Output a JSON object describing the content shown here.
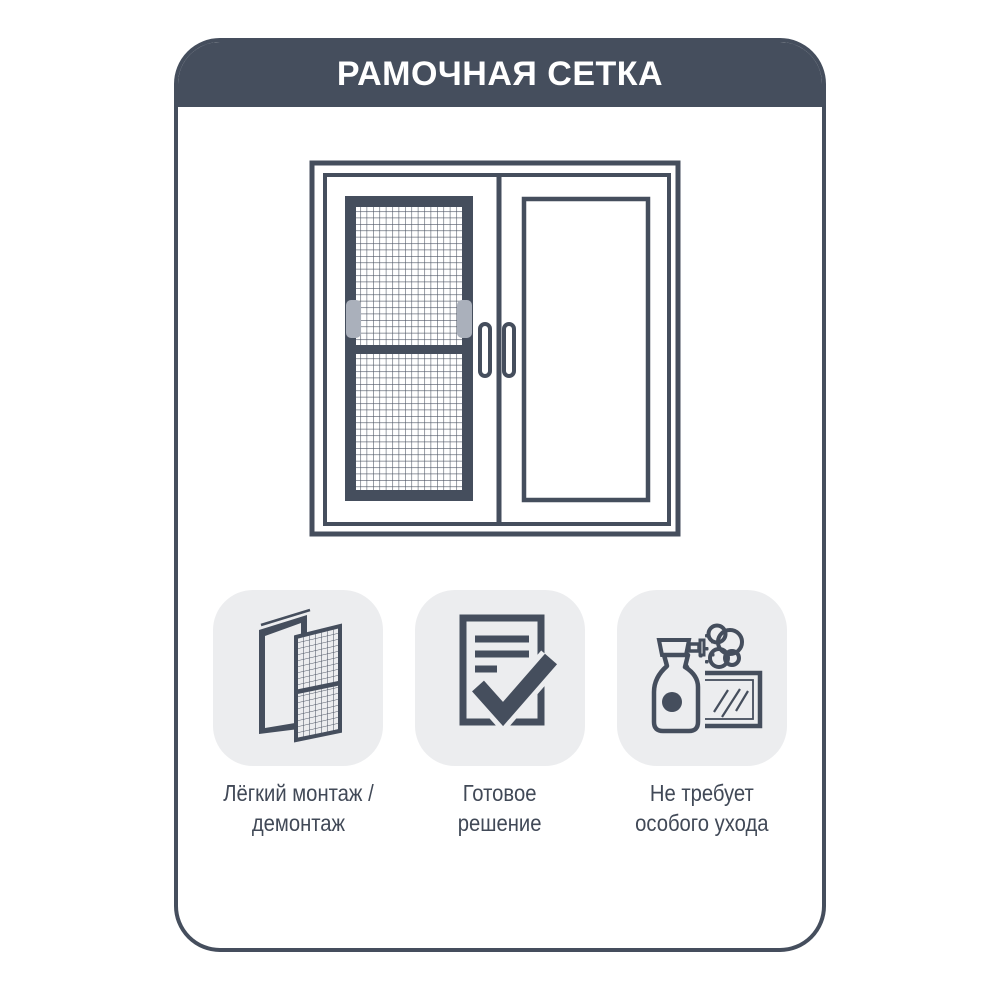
{
  "header": {
    "title": "РАМОЧНАЯ СЕТКА"
  },
  "illustration": {
    "description": "window with framed mosquito net in left sash and clear glass in right sash"
  },
  "features": [
    {
      "icon": "easy-install-icon",
      "label_line1": "Лёгкий монтаж /",
      "label_line2": "демонтаж"
    },
    {
      "icon": "ready-solution-icon",
      "label_line1": "Готовое",
      "label_line2": "решение"
    },
    {
      "icon": "easy-care-icon",
      "label_line1": "Не требует",
      "label_line2": "особого ухода"
    }
  ],
  "colors": {
    "accent": "#454e5d",
    "tile_background": "#ecedef",
    "handle_tab_gray": "#aab0bb",
    "background": "#ffffff"
  }
}
